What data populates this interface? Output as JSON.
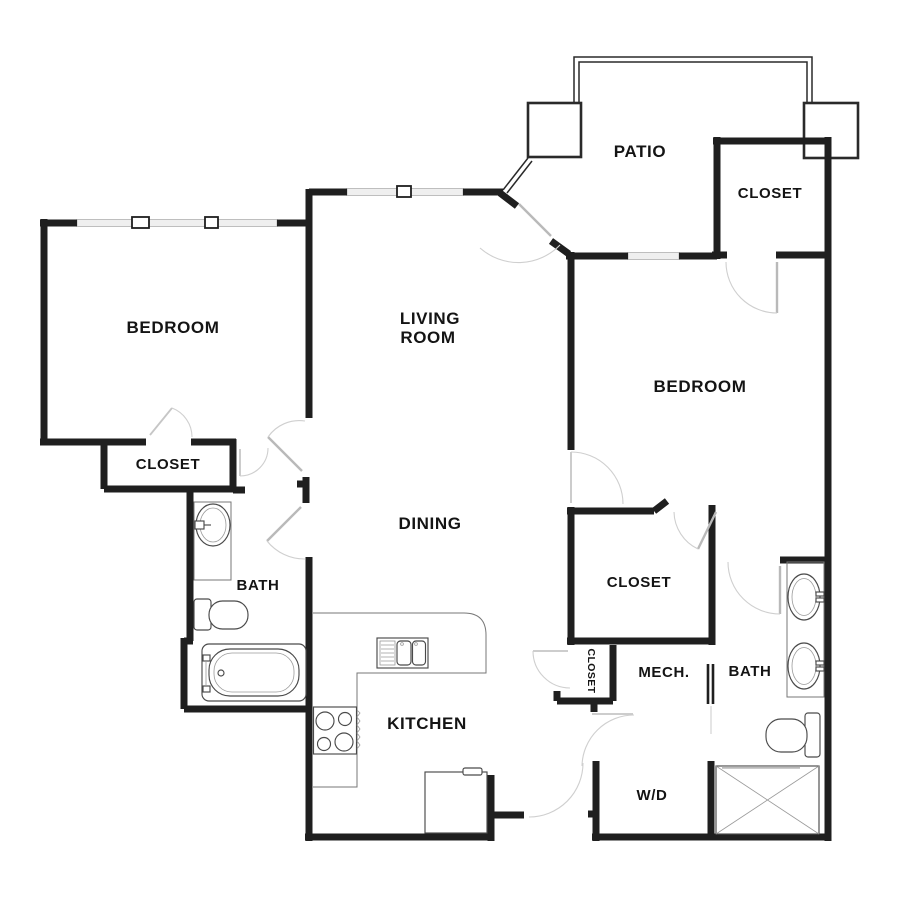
{
  "plan": {
    "type": "apartment-floor-plan",
    "rooms": {
      "patio": "PATIO",
      "closet_top_right": "CLOSET",
      "bedroom_left": "BEDROOM",
      "living_line1": "LIVING",
      "living_line2": "ROOM",
      "bedroom_right": "BEDROOM",
      "closet_bedroom_left": "CLOSET",
      "bath_left": "BATH",
      "dining": "DINING",
      "closet_walk_in": "CLOSET",
      "closet_hall": "CLOSET",
      "mech": "MECH.",
      "bath_right": "BATH",
      "kitchen": "KITCHEN",
      "washer_dryer": "W/D"
    },
    "fixtures": [
      "bathtub-icon",
      "toilet-icon",
      "vanity-sink-icon",
      "double-vanity-sink-icon",
      "second-toilet-icon",
      "shower-icon",
      "kitchen-sink-icon",
      "stove-icon",
      "refrigerator-icon",
      "patio-column-icon",
      "patio-railing-icon"
    ],
    "colors": {
      "wall": "#1f1f1f",
      "fixture_outline": "#4a4a4a",
      "door_arc": "#cfcfcf",
      "door_leaf": "#b9b9b9",
      "window_fill": "#efefef",
      "label": "#141414",
      "background": "#ffffff"
    }
  }
}
